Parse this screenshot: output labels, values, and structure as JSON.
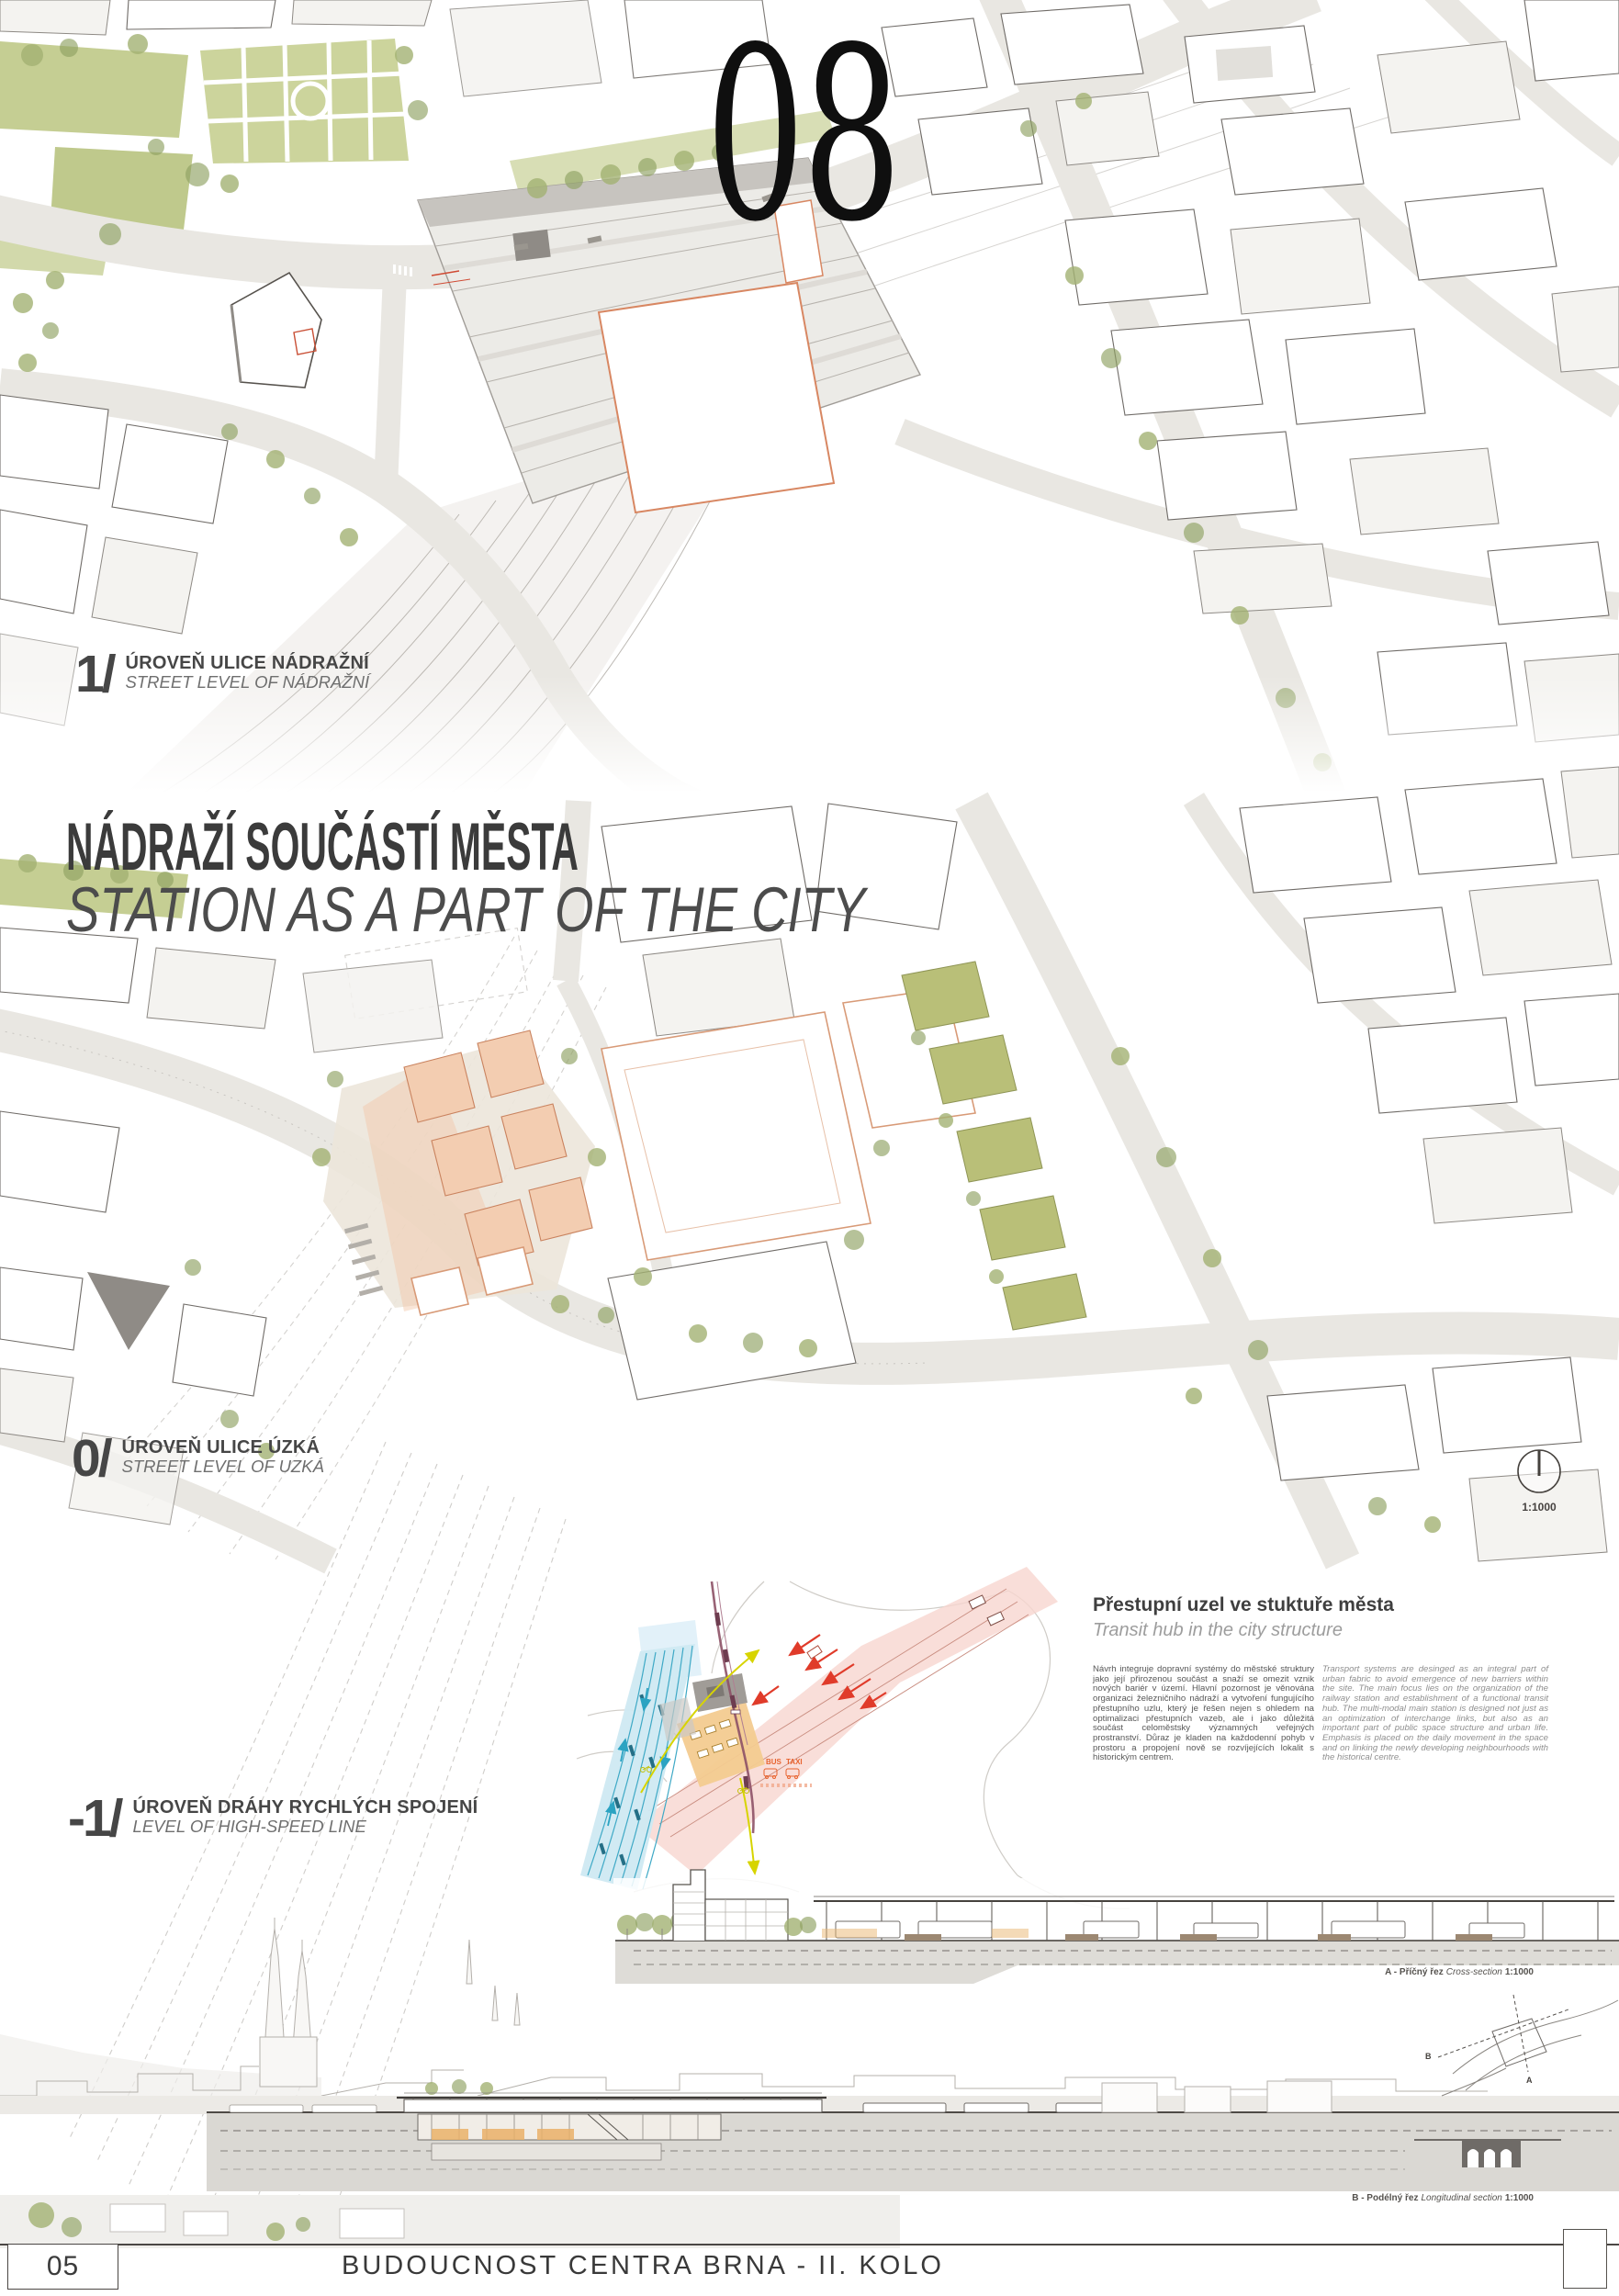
{
  "sheet": {
    "number": "08"
  },
  "main_title": {
    "cz": "NÁDRAŽÍ SOUČÁSTÍ MĚSTA",
    "en": "STATION AS A PART OF THE CITY"
  },
  "levels": [
    {
      "num": "1/",
      "cz": "ÚROVEŇ ULICE NÁDRAŽNÍ",
      "en": "STREET LEVEL OF NÁDRAŽNÍ"
    },
    {
      "num": "0/",
      "cz": "ÚROVEŇ ULICE ÚZKÁ",
      "en": "STREET LEVEL OF UZKÁ"
    },
    {
      "num": "-1/",
      "cz": "ÚROVEŇ DRÁHY RYCHLÝCH SPOJENÍ",
      "en": "LEVEL OF HIGH-SPEED LINE"
    }
  ],
  "transit_hub": {
    "heading_cz": "Přestupní uzel ve stuktuře města",
    "heading_en": "Transit hub in the city structure",
    "paragraph_cz": "Návrh integruje dopravní systémy do městské struktury jako její přirozenou součást a snaží se omezit vznik nových bariér v území. Hlavní pozornost je věnována organizaci železničního nádraží a vytvoření fungujícího přestupního uzlu, který je řešen nejen s ohledem na optimalizaci přestupních vazeb, ale i jako důležitá součást celoměstsky významných veřejných prostranství. Důraz je kladen na každodenní pohyb v prostoru a propojení nově se rozvíjejících lokalit s historickým centrem.",
    "paragraph_en": "Transport systems are desinged as an integral part of urban fabric to avoid emergence of new barriers within the site. The main focus lies on the organization of the railway station and establishment of a functional transit hub. The multi-modal main station is designed not just as an optimization of interchange links, but also as an important part of public space structure and urban life. Emphasis is placed on the daily movement in the space and on linking the newly developing neighbourhoods with the historical centre."
  },
  "north_arrow": {
    "scale": "1:1000"
  },
  "section_captions": {
    "a_cz": "A - Příčný řez",
    "a_en": "Cross-section",
    "a_scale": "1:1000",
    "b_cz": "B - Podélný řez",
    "b_en": "Longitudinal section",
    "b_scale": "1:1000",
    "key_a": "A",
    "key_b": "B"
  },
  "diagram_labels": {
    "bus": "BUS",
    "taxi": "TAXI"
  },
  "footer": {
    "page_number": "05",
    "competition_title": "BUDOUCNOST CENTRA BRNA - II. KOLO"
  },
  "colors": {
    "park_green": "#c3cc8f",
    "development_salmon": "#f3cdb1",
    "rail_red": "#e03b2a",
    "high_speed_cyan": "#45b1cc",
    "tram_purple": "#8d5166",
    "cycling_yellow": "#d7d400",
    "bus_taxi_orange": "#e8632e",
    "text_dark": "#3c3c3c"
  }
}
